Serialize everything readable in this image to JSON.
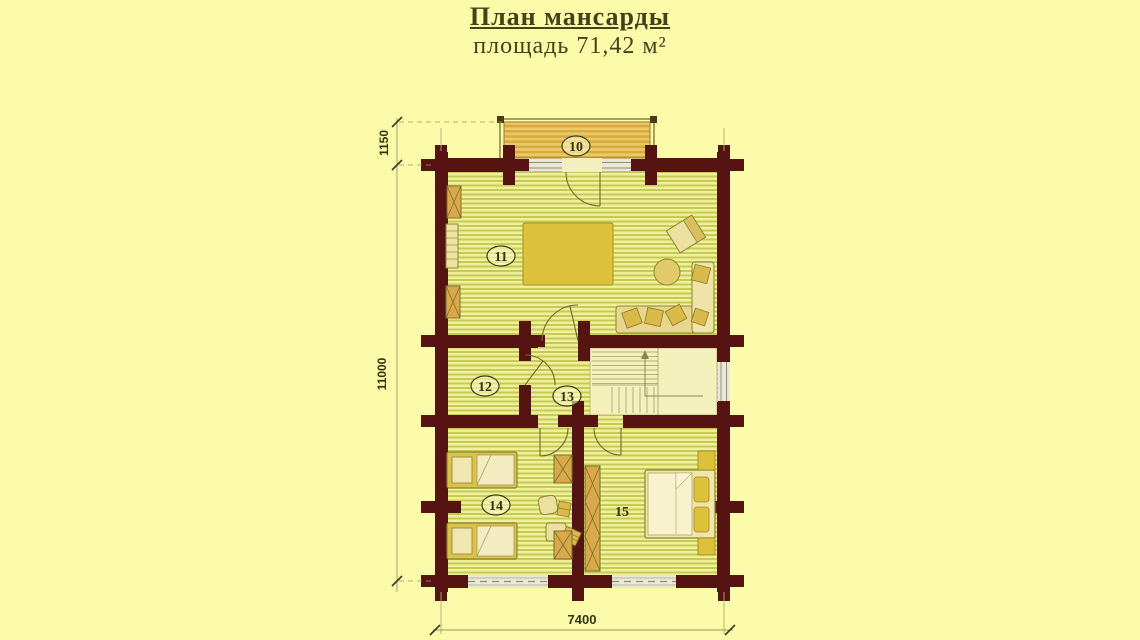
{
  "title": {
    "heading": "План мансарды",
    "subtitle": "площадь 71,42 м²"
  },
  "dimensions": {
    "balcony_depth": "1150",
    "side_length": "11000",
    "bottom_width": "7400"
  },
  "room_labels": {
    "r10": "10",
    "r11": "11",
    "r12": "12",
    "r13": "13",
    "r14": "14",
    "r15": "15"
  },
  "colors": {
    "background": "#fcfbaa",
    "wall": "#551412",
    "floor_stripe_light": "#eef09e",
    "floor_stripe_dark": "#c6ca52",
    "stair_floor": "#f3f0bc",
    "balcony_stripe_light": "#e9c96a",
    "balcony_stripe_dark": "#d9a93c",
    "furniture_light": "#ece0a0",
    "furniture_accent": "#ddc13a",
    "wardrobe": "#d9a84a",
    "outline": "#8a8530",
    "text": "#35330f"
  }
}
